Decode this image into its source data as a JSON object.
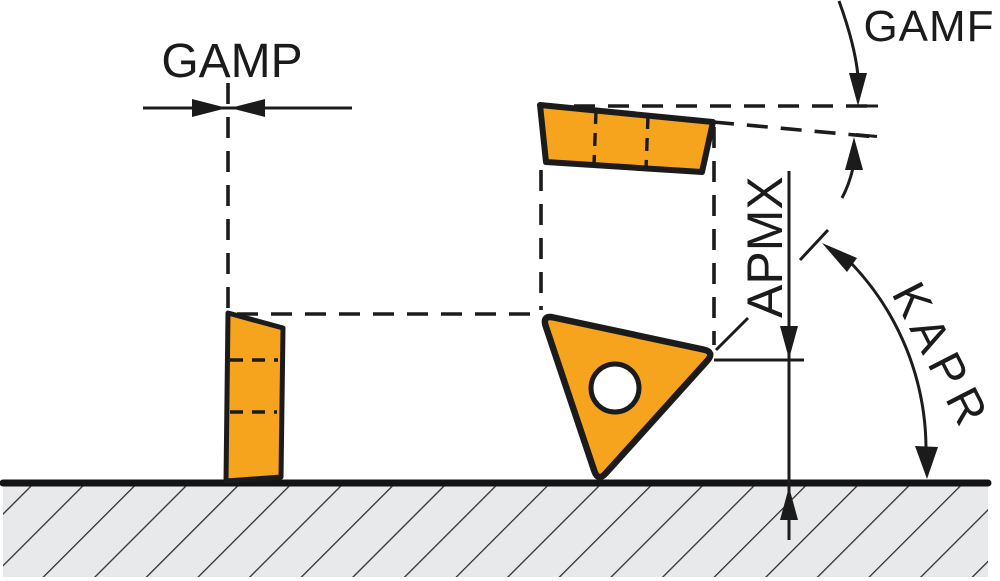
{
  "diagram": {
    "description_labels": {
      "gamp": "GAMP",
      "gamf": "GAMF",
      "apmx": "APMX",
      "kapr": "KAPR"
    },
    "colors": {
      "insert_fill": "#F6A31E",
      "line": "#1C1C1C",
      "hatch_bg": "#E8E9EB",
      "hatch_line": "#2F2F2F",
      "background": "#FFFFFF"
    }
  }
}
